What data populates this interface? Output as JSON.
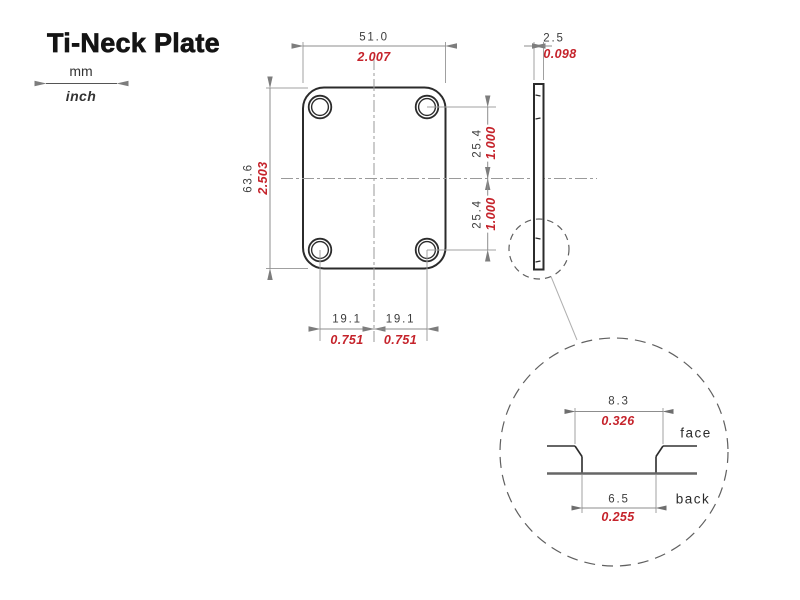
{
  "title": "Ti-Neck Plate",
  "legend": {
    "mm_label": "mm",
    "inch_label": "inch"
  },
  "dims": {
    "plate_width": {
      "mm": "51.0",
      "inch": "2.007"
    },
    "plate_height": {
      "mm": "63.6",
      "inch": "2.503"
    },
    "hole_spacing_upper": {
      "mm": "25.4",
      "inch": "1.000"
    },
    "hole_spacing_lower": {
      "mm": "25.4",
      "inch": "1.000"
    },
    "hole_offset_left": {
      "mm": "19.1",
      "inch": "0.751"
    },
    "hole_offset_right": {
      "mm": "19.1",
      "inch": "0.751"
    },
    "thickness": {
      "mm": "2.5",
      "inch": "0.098"
    },
    "countersink_face": {
      "mm": "8.3",
      "inch": "0.326"
    },
    "hole_back": {
      "mm": "6.5",
      "inch": "0.255"
    }
  },
  "detail": {
    "face_label": "face",
    "back_label": "back"
  },
  "colors": {
    "inch_red": "#c5232b",
    "outline_black": "#2b2b2b",
    "dim_gray": "#a0a0a0",
    "centerline_gray": "#9a9a9a"
  }
}
